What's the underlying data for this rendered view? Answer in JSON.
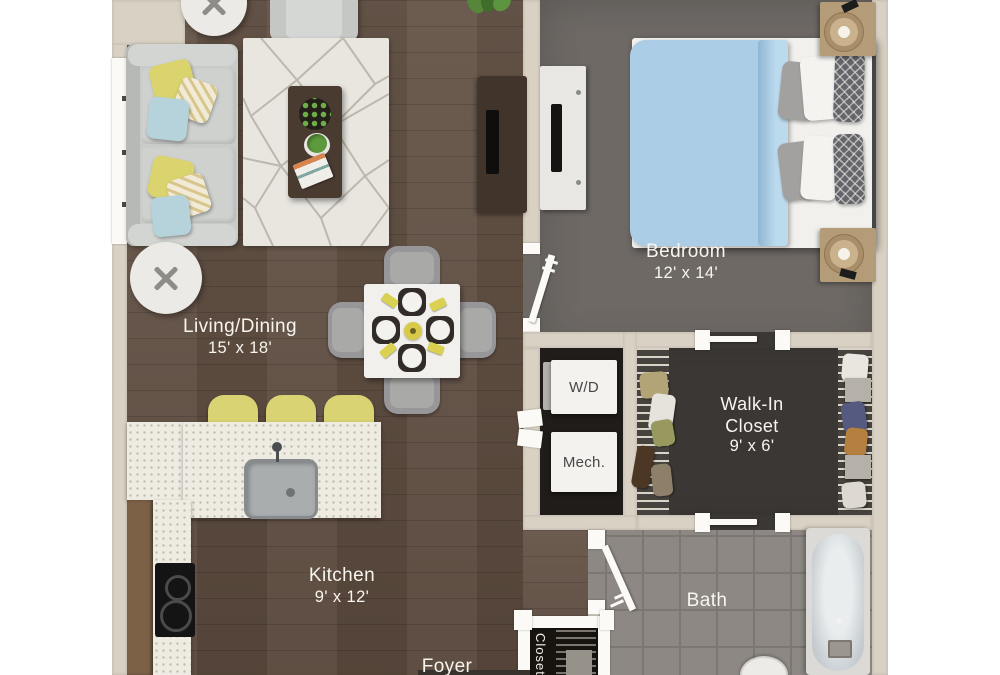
{
  "rooms": {
    "living_dining": {
      "label": "Living/Dining",
      "dimensions": "15' x 18'"
    },
    "bedroom": {
      "label": "Bedroom",
      "dimensions": "12' x 14'"
    },
    "walk_in_closet": {
      "label_line1": "Walk-In",
      "label_line2": "Closet",
      "dimensions": "9' x 6'"
    },
    "kitchen": {
      "label": "Kitchen",
      "dimensions": "9' x 12'"
    },
    "bath": {
      "label": "Bath"
    },
    "foyer": {
      "label": "Foyer"
    },
    "laundry_mech": {
      "washer_dryer": "W/D",
      "mechanical": "Mech."
    },
    "foyer_closet": {
      "label": "Closet"
    }
  },
  "palette": {
    "background": "#ffffff",
    "wall": "#d9d1c3",
    "wood_floor": "#5f4d40",
    "bedroom_floor": "#6e6965",
    "walk_in_floor": "#3b3734",
    "laundry_floor": "#201c19",
    "bath_tile": "#8d8883",
    "counter": "#eeebe2",
    "accent_yellow": "#dbd36e",
    "accent_blue": "#abcde5",
    "label_text": "#f8f5ef"
  }
}
